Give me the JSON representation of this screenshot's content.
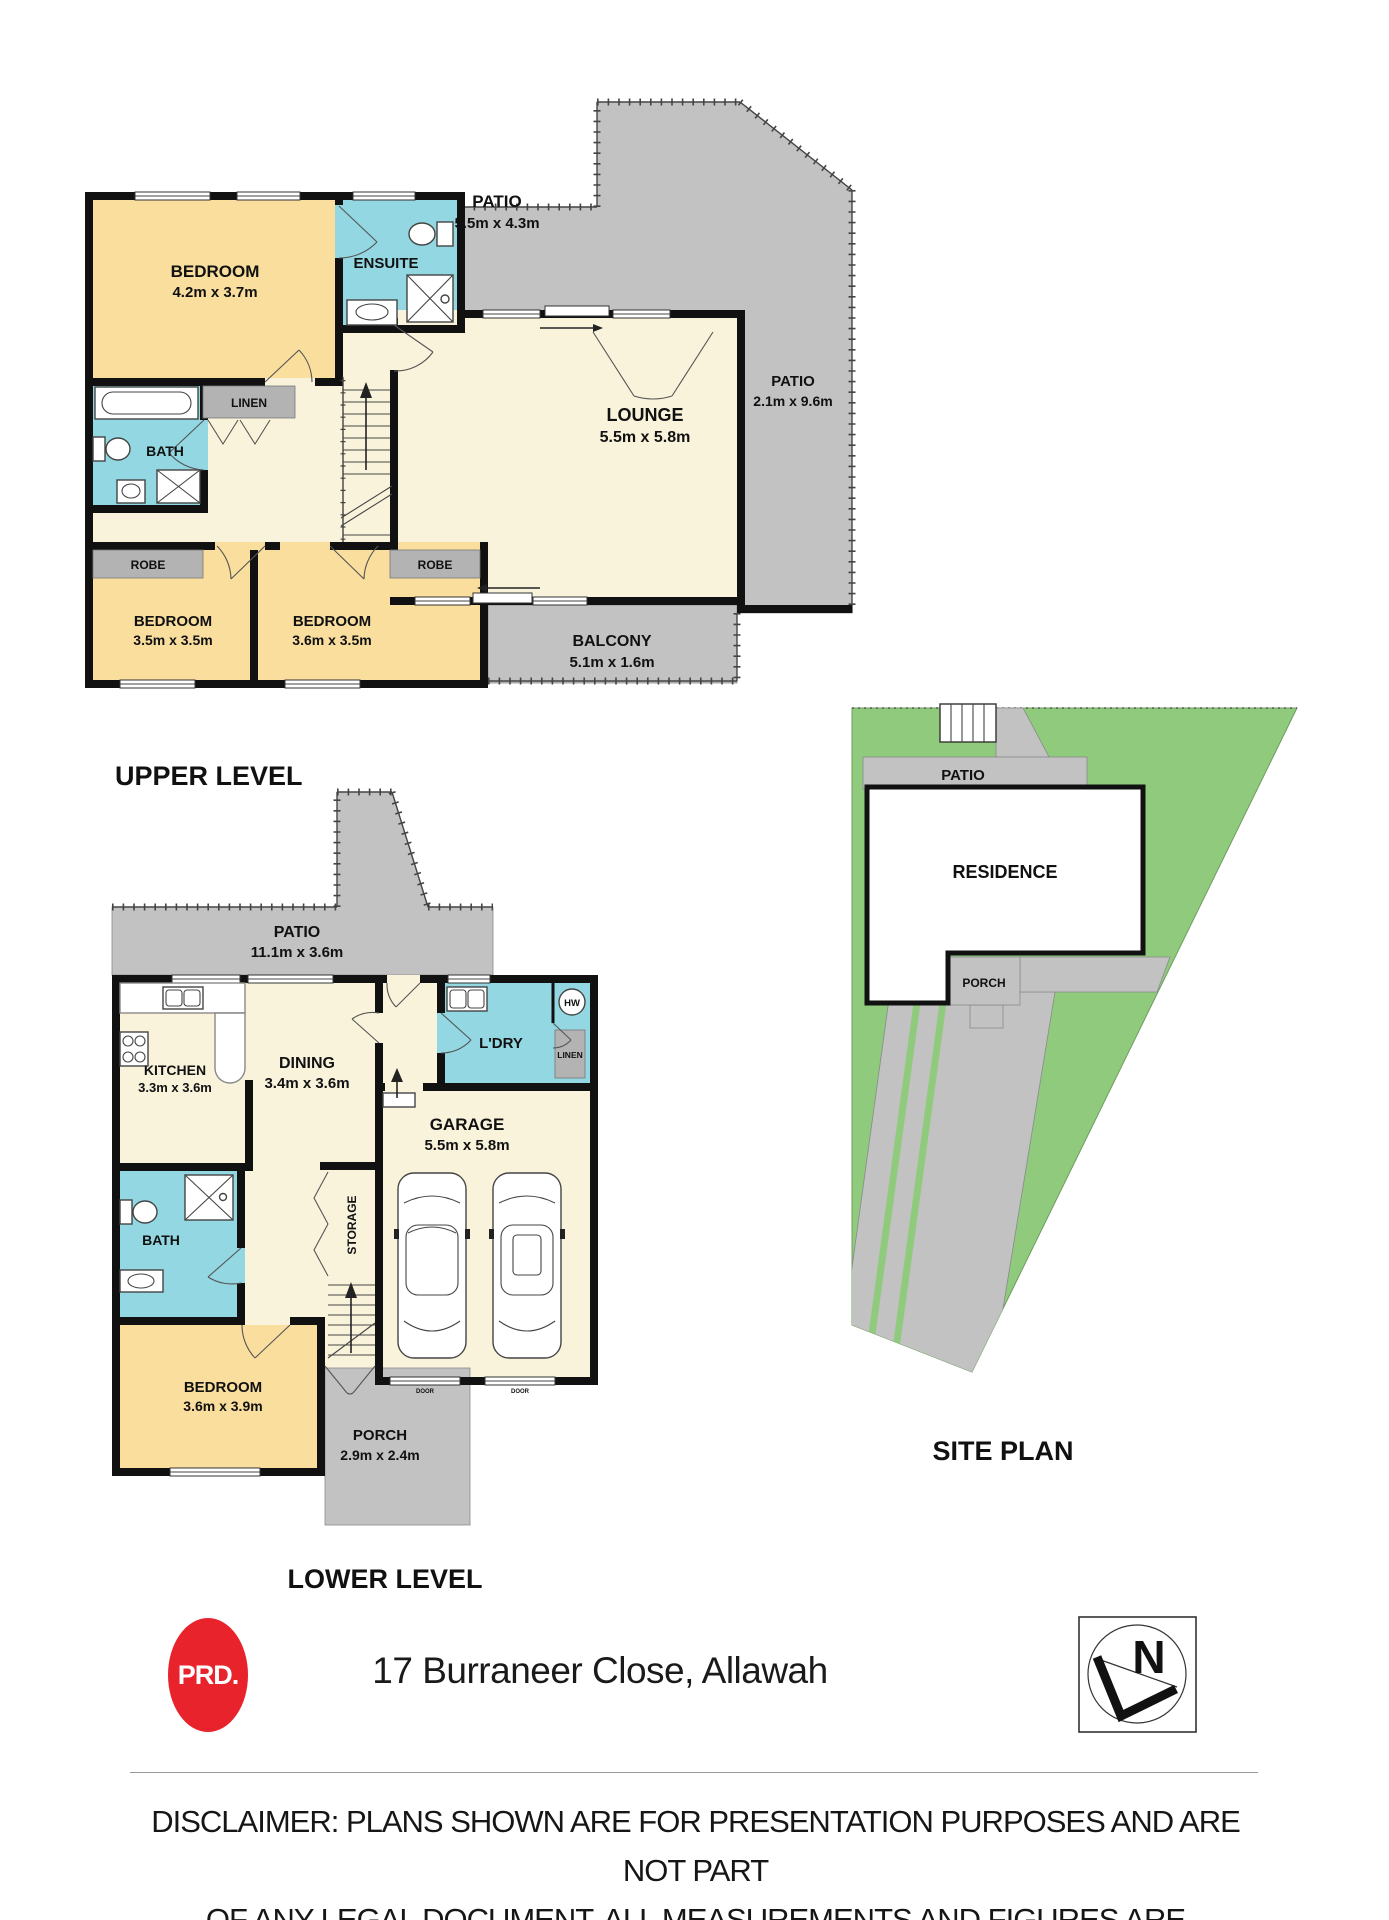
{
  "upper_level": {
    "label": "UPPER LEVEL",
    "rooms": {
      "bedroom_main": {
        "name": "BEDROOM",
        "dims": "4.2m x 3.7m"
      },
      "ensuite": {
        "name": "ENSUITE"
      },
      "patio_rear": {
        "name": "PATIO",
        "dims": "5.5m x 4.3m"
      },
      "patio_side": {
        "name": "PATIO",
        "dims": "2.1m x 9.6m"
      },
      "lounge": {
        "name": "LOUNGE",
        "dims": "5.5m x 5.8m"
      },
      "bath": {
        "name": "BATH"
      },
      "linen": {
        "name": "LINEN"
      },
      "robe_left": {
        "name": "ROBE"
      },
      "robe_right": {
        "name": "ROBE"
      },
      "bedroom_left": {
        "name": "BEDROOM",
        "dims": "3.5m x 3.5m"
      },
      "bedroom_mid": {
        "name": "BEDROOM",
        "dims": "3.6m x 3.5m"
      },
      "balcony": {
        "name": "BALCONY",
        "dims": "5.1m x 1.6m"
      }
    }
  },
  "lower_level": {
    "label": "LOWER LEVEL",
    "rooms": {
      "patio": {
        "name": "PATIO",
        "dims": "11.1m x 3.6m"
      },
      "kitchen": {
        "name": "KITCHEN",
        "dims": "3.3m x 3.6m"
      },
      "dining": {
        "name": "DINING",
        "dims": "3.4m x 3.6m"
      },
      "laundry": {
        "name": "L'DRY"
      },
      "linen": {
        "name": "LINEN"
      },
      "hot_water": {
        "name": "HW"
      },
      "garage": {
        "name": "GARAGE",
        "dims": "5.5m x 5.8m",
        "door_label": "DOOR"
      },
      "storage": {
        "name": "STORAGE"
      },
      "bath": {
        "name": "BATH"
      },
      "bedroom": {
        "name": "BEDROOM",
        "dims": "3.6m x 3.9m"
      },
      "porch": {
        "name": "PORCH",
        "dims": "2.9m x 2.4m"
      }
    }
  },
  "site_plan": {
    "label": "SITE PLAN",
    "areas": {
      "patio": "PATIO",
      "residence": "RESIDENCE",
      "porch": "PORCH"
    }
  },
  "footer": {
    "agency_logo": "PRD.",
    "address": "17 Burraneer Close, Allawah",
    "compass_letter": "N",
    "disclaimer_line1": "DISCLAIMER: PLANS SHOWN ARE FOR PRESENTATION PURPOSES AND ARE NOT PART",
    "disclaimer_line2": "OF ANY LEGAL DOCUMENT. ALL MEASUREMENTS AND FIGURES ARE APPROXIMATE"
  },
  "colors": {
    "room_cream": "#FAF3DC",
    "room_yellow": "#F9DE9E",
    "wet_area_blue": "#92D7E1",
    "hard_surface_gray": "#C2C2C2",
    "closet_gray": "#B3B3B3",
    "site_green": "#8FCA7D",
    "wall_black": "#111111",
    "logo_red": "#E8232B"
  }
}
